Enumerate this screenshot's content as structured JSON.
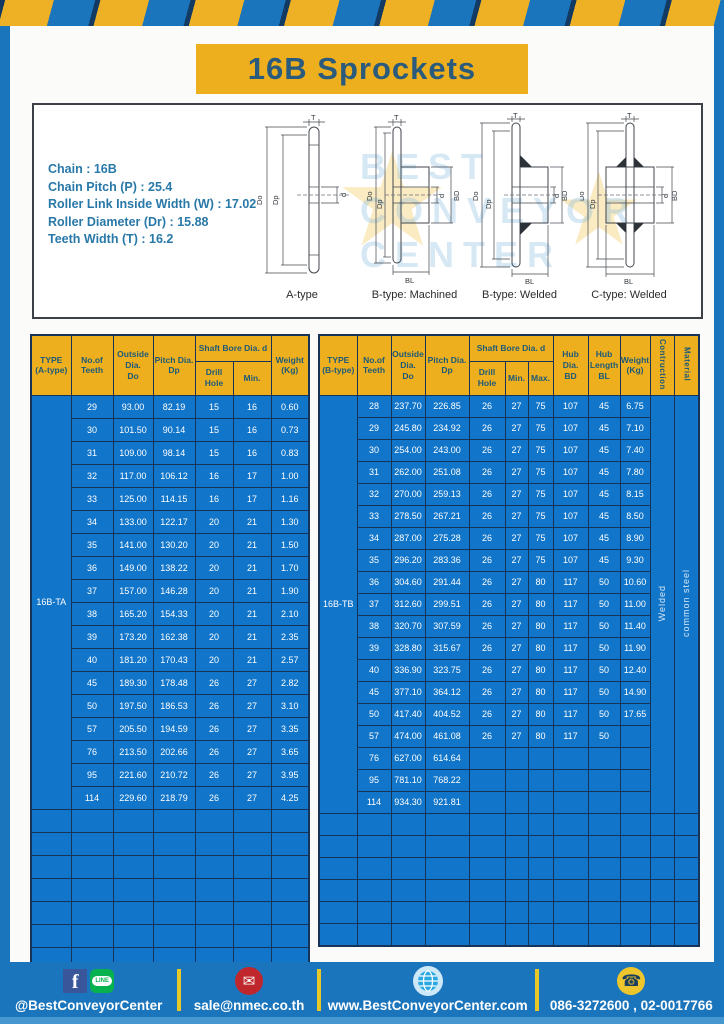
{
  "page_title": "16B Sprockets",
  "colors": {
    "frame_blue": "#1b75bc",
    "cell_blue": "#1175c9",
    "grid_navy": "#173358",
    "accent_yellow": "#eeaf1e",
    "teal_text": "#1d5a78",
    "footer_strip": "#4697cf",
    "separator_yellow": "#e6c829"
  },
  "specs": {
    "lines": [
      "Chain  :  16B",
      "Chain Pitch (P)  :  25.4",
      "Roller Link Inside Width (W)  :  17.02",
      "Roller Diameter (Dr)  : 15.88",
      "Teeth Width (T)  :  16.2"
    ]
  },
  "watermark": {
    "line1": "BEST",
    "line2": "CONVEYOR",
    "line3": "CENTER",
    "star": "★"
  },
  "diagrams": {
    "captions": [
      "A-type",
      "B-type: Machined",
      "B-type: Welded",
      "C-type: Welded"
    ],
    "dims": {
      "t": "T",
      "outer": "Do",
      "pitch": "Dp",
      "bore": "d",
      "hub_dia": "BD",
      "hub_len": "BL"
    }
  },
  "table_a": {
    "headers": {
      "type": "TYPE\n(A-type)",
      "teeth": "No.of\nTeeth",
      "outside": "Outside\nDia.\nDo",
      "pitch": "Pitch Dia.\nDp",
      "shaft": "Shaft Bore Dia. d",
      "drill": "Drill Hole",
      "min": "Min.",
      "weight": "Weight\n(Kg)"
    },
    "type_value": "16B-TA",
    "rows": [
      [
        "29",
        "93.00",
        "82.19",
        "15",
        "16",
        "0.60"
      ],
      [
        "30",
        "101.50",
        "90.14",
        "15",
        "16",
        "0.73"
      ],
      [
        "31",
        "109.00",
        "98.14",
        "15",
        "16",
        "0.83"
      ],
      [
        "32",
        "117.00",
        "106.12",
        "16",
        "17",
        "1.00"
      ],
      [
        "33",
        "125.00",
        "114.15",
        "16",
        "17",
        "1.16"
      ],
      [
        "34",
        "133.00",
        "122.17",
        "20",
        "21",
        "1.30"
      ],
      [
        "35",
        "141.00",
        "130.20",
        "20",
        "21",
        "1.50"
      ],
      [
        "36",
        "149.00",
        "138.22",
        "20",
        "21",
        "1.70"
      ],
      [
        "37",
        "157.00",
        "146.28",
        "20",
        "21",
        "1.90"
      ],
      [
        "38",
        "165.20",
        "154.33",
        "20",
        "21",
        "2.10"
      ],
      [
        "39",
        "173.20",
        "162.38",
        "20",
        "21",
        "2.35"
      ],
      [
        "40",
        "181.20",
        "170.43",
        "20",
        "21",
        "2.57"
      ],
      [
        "45",
        "189.30",
        "178.48",
        "26",
        "27",
        "2.82"
      ],
      [
        "50",
        "197.50",
        "186.53",
        "26",
        "27",
        "3.10"
      ],
      [
        "57",
        "205.50",
        "194.59",
        "26",
        "27",
        "3.35"
      ],
      [
        "76",
        "213.50",
        "202.66",
        "26",
        "27",
        "3.65"
      ],
      [
        "95",
        "221.60",
        "210.72",
        "26",
        "27",
        "3.95"
      ],
      [
        "114",
        "229.60",
        "218.79",
        "26",
        "27",
        "4.25"
      ]
    ],
    "empty_rows": 7,
    "empty_cols": 7
  },
  "table_b": {
    "headers": {
      "type": "TYPE\n(B-type)",
      "teeth": "No.of\nTeeth",
      "outside": "Outside\nDia.\nDo",
      "pitch": "Pitch Dia.\nDp",
      "shaft": "Shaft Bore Dia. d",
      "drill": "Drill Hole",
      "min": "Min.",
      "max": "Max.",
      "hub_dia": "Hub Dia.\nBD",
      "hub_len": "Hub\nLength\nBL",
      "weight": "Weight\n(Kg)",
      "construction": "Contruction",
      "material": "Material"
    },
    "type_value": "16B-TB",
    "construction_value": "Welded",
    "material_value": "common steel",
    "rows": [
      [
        "28",
        "237.70",
        "226.85",
        "26",
        "27",
        "75",
        "107",
        "45",
        "6.75"
      ],
      [
        "29",
        "245.80",
        "234.92",
        "26",
        "27",
        "75",
        "107",
        "45",
        "7.10"
      ],
      [
        "30",
        "254.00",
        "243.00",
        "26",
        "27",
        "75",
        "107",
        "45",
        "7.40"
      ],
      [
        "31",
        "262.00",
        "251.08",
        "26",
        "27",
        "75",
        "107",
        "45",
        "7.80"
      ],
      [
        "32",
        "270.00",
        "259.13",
        "26",
        "27",
        "75",
        "107",
        "45",
        "8.15"
      ],
      [
        "33",
        "278.50",
        "267.21",
        "26",
        "27",
        "75",
        "107",
        "45",
        "8.50"
      ],
      [
        "34",
        "287.00",
        "275.28",
        "26",
        "27",
        "75",
        "107",
        "45",
        "8.90"
      ],
      [
        "35",
        "296.20",
        "283.36",
        "26",
        "27",
        "75",
        "107",
        "45",
        "9.30"
      ],
      [
        "36",
        "304.60",
        "291.44",
        "26",
        "27",
        "80",
        "117",
        "50",
        "10.60"
      ],
      [
        "37",
        "312.60",
        "299.51",
        "26",
        "27",
        "80",
        "117",
        "50",
        "11.00"
      ],
      [
        "38",
        "320.70",
        "307.59",
        "26",
        "27",
        "80",
        "117",
        "50",
        "11.40"
      ],
      [
        "39",
        "328.80",
        "315.67",
        "26",
        "27",
        "80",
        "117",
        "50",
        "11.90"
      ],
      [
        "40",
        "336.90",
        "323.75",
        "26",
        "27",
        "80",
        "117",
        "50",
        "12.40"
      ],
      [
        "45",
        "377.10",
        "364.12",
        "26",
        "27",
        "80",
        "117",
        "50",
        "14.90"
      ],
      [
        "50",
        "417.40",
        "404.52",
        "26",
        "27",
        "80",
        "117",
        "50",
        "17.65"
      ],
      [
        "57",
        "474.00",
        "461.08",
        "26",
        "27",
        "80",
        "117",
        "50",
        ""
      ],
      [
        "76",
        "627.00",
        "614.64",
        "",
        "",
        "",
        "",
        "",
        ""
      ],
      [
        "95",
        "781.10",
        "768.22",
        "",
        "",
        "",
        "",
        "",
        ""
      ],
      [
        "114",
        "934.30",
        "921.81",
        "",
        "",
        "",
        "",
        "",
        ""
      ]
    ],
    "empty_rows": 6,
    "empty_cols": 12
  },
  "footer": {
    "social_label": "@BestConveyorCenter",
    "email": "sale@nmec.co.th",
    "website": "www.BestConveyorCenter.com",
    "phones": "086-3272600 , 02-0017766",
    "icons": {
      "facebook": "f",
      "line": "LINE",
      "mail": "✉",
      "globe": "globe",
      "phone": "☎"
    }
  }
}
